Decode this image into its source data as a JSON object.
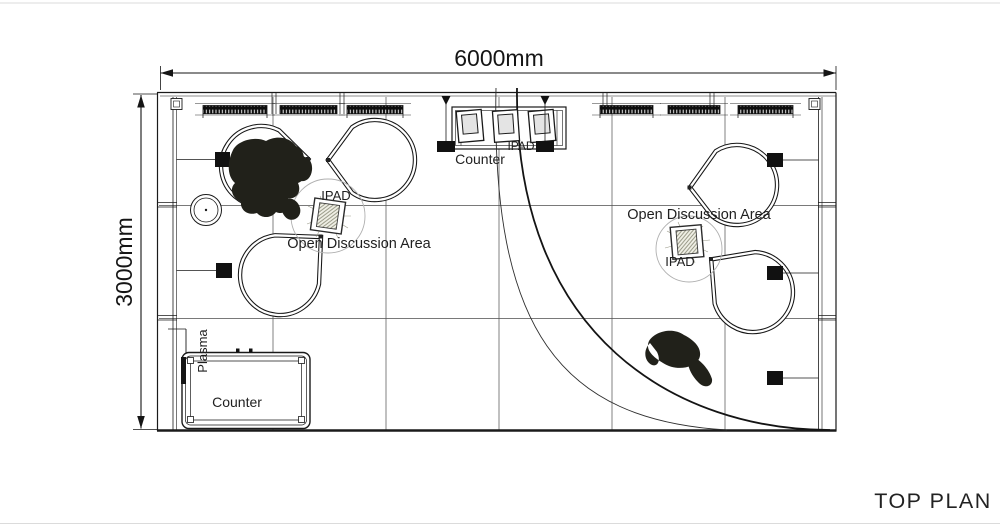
{
  "drawing": {
    "title": "TOP PLAN",
    "dimensions": {
      "width_label": "6000mm",
      "height_label": "3000mm"
    },
    "left_area": {
      "label": "Open Discussion Area",
      "ipad_label": "IPAD"
    },
    "right_area": {
      "label": "Open Discussion Area",
      "ipad_label": "IPAD"
    },
    "top_counter": {
      "label": "Counter",
      "ipad_label": "IPAD"
    },
    "bottom_counter": {
      "label": "Counter",
      "plasma_label": "Plasma"
    },
    "colors": {
      "line": "#1a1a1a",
      "grid": "#4d4d4d",
      "light_circle": "#b0b0b0",
      "figure": "#21211a",
      "background": "#ffffff"
    }
  }
}
